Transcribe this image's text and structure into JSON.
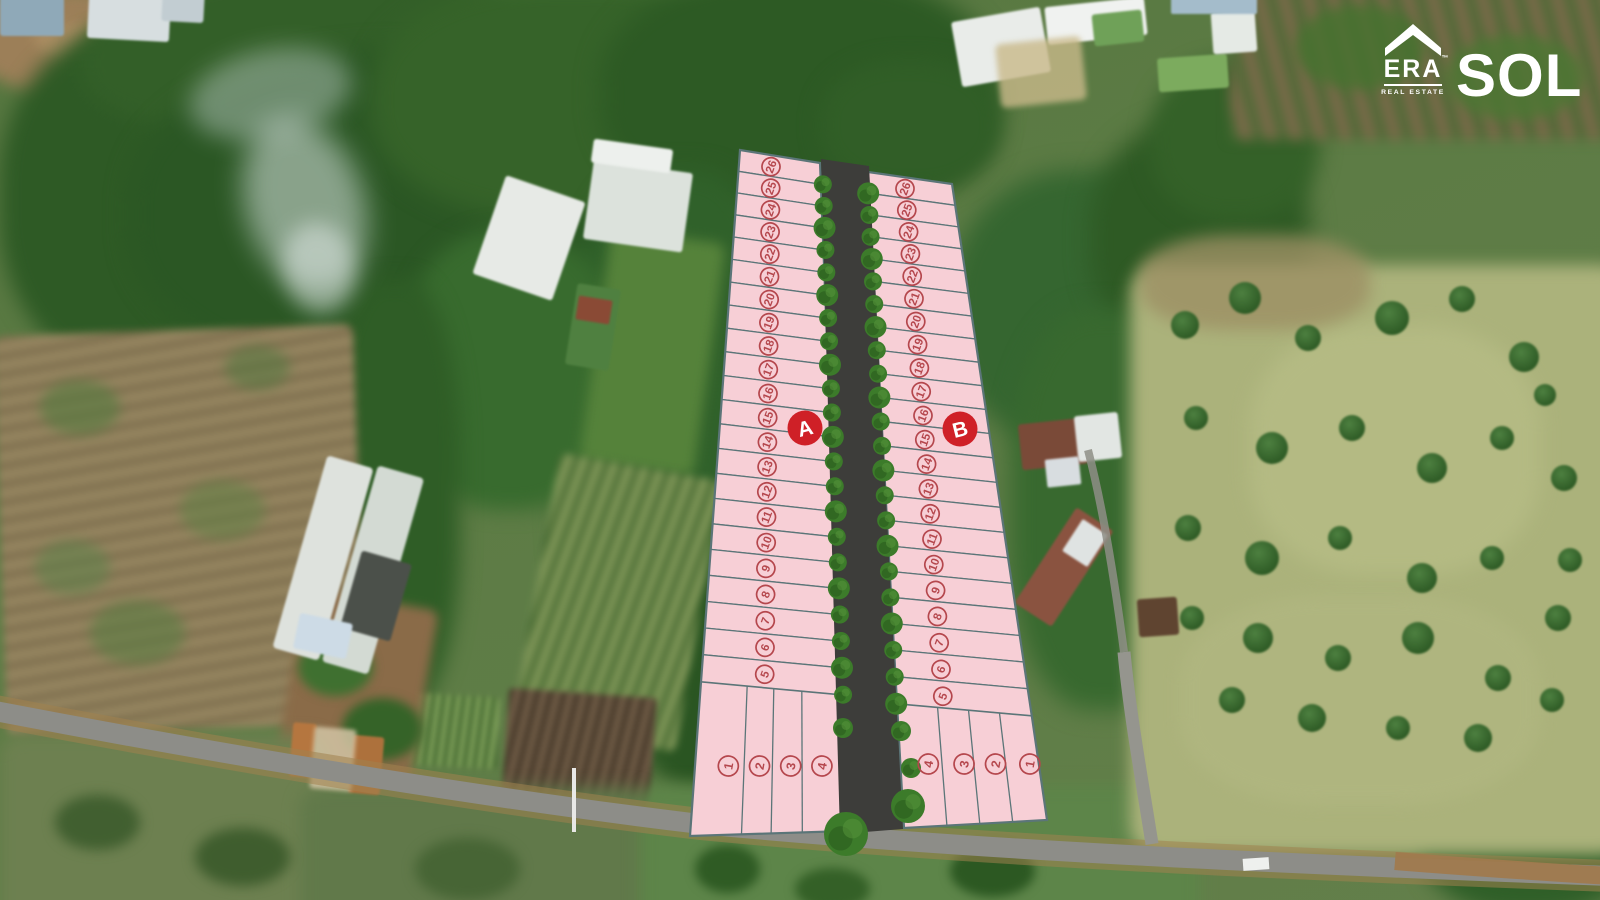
{
  "brand": {
    "era_wordmark": "ERA",
    "era_trademark": "™",
    "era_tagline": "REAL ESTATE",
    "project_name": "SOL"
  },
  "site_plan": {
    "blocks": [
      {
        "label": "A",
        "strip_plots": [
          "26",
          "25",
          "24",
          "23",
          "22",
          "21",
          "20",
          "19",
          "18",
          "17",
          "16",
          "15",
          "14",
          "13",
          "12",
          "11",
          "10",
          "9",
          "8",
          "7",
          "6",
          "5"
        ],
        "bottom_plots": [
          "1",
          "2",
          "3",
          "4"
        ]
      },
      {
        "label": "B",
        "strip_plots": [
          "26",
          "25",
          "24",
          "23",
          "22",
          "21",
          "20",
          "19",
          "18",
          "17",
          "16",
          "15",
          "14",
          "13",
          "12",
          "11",
          "10",
          "9",
          "8",
          "7",
          "6",
          "5"
        ],
        "bottom_plots": [
          "4",
          "3",
          "2",
          "1"
        ]
      }
    ]
  },
  "colors": {
    "plot_fill": "#f7cfd6",
    "plot_border": "#5b7578",
    "plot_number": "#b5474d",
    "badge": "#cf2027",
    "badge_text": "#ffffff",
    "new_road": "#3d3d3a",
    "roadside_tree": "#3c7b2a",
    "asphalt_road": "#8d8d88",
    "dirt_shoulder": "#a1814e"
  }
}
